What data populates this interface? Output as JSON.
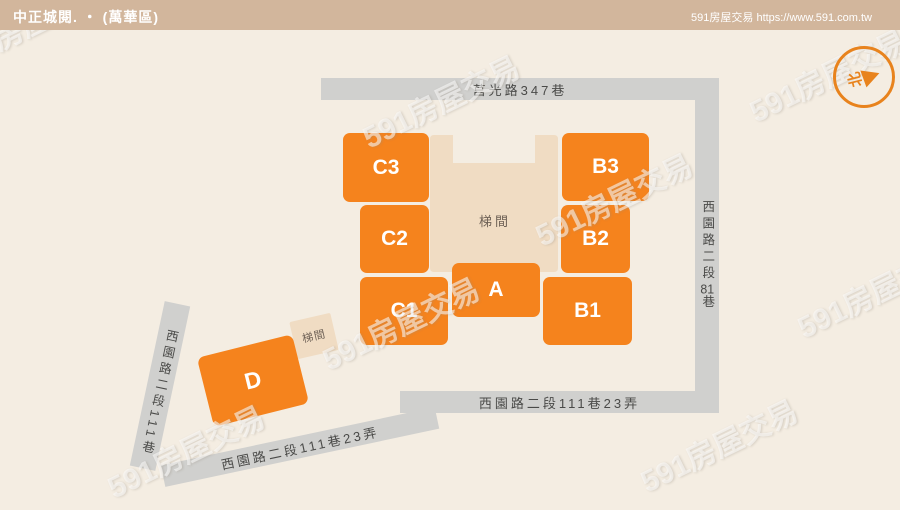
{
  "header": {
    "title": "中正城閱. ・ (萬華區)",
    "site": "591房屋交易 https://www.591.com.tw"
  },
  "compass": {
    "label": "北"
  },
  "roads": {
    "top": {
      "name": "莒光路347巷"
    },
    "right": {
      "part1": "西園路二段",
      "num": "81",
      "part2": "巷"
    },
    "bottom": {
      "name": "西園路二段111巷23弄"
    },
    "diagonal": {
      "name": "西園路二段111巷23弄"
    },
    "left": {
      "part1": "西園路二段",
      "num": "111",
      "part2": "巷"
    }
  },
  "buildings": [
    {
      "id": "C3",
      "label": "C3"
    },
    {
      "id": "B3",
      "label": "B3"
    },
    {
      "id": "C2",
      "label": "C2"
    },
    {
      "id": "B2",
      "label": "B2"
    },
    {
      "id": "C1",
      "label": "C1"
    },
    {
      "id": "A",
      "label": "A"
    },
    {
      "id": "B1",
      "label": "B1"
    },
    {
      "id": "D",
      "label": "D"
    }
  ],
  "stairwells": {
    "center": {
      "label": "梯間"
    },
    "near_d": {
      "label": "梯間"
    }
  },
  "watermark": {
    "text": "591房屋交易"
  },
  "colors": {
    "accent_orange": "#f5831d",
    "road_gray": "#d0d0ce",
    "stair_beige": "#f0dcc3",
    "header_tan": "#d2b69c",
    "background": "#f4ede2",
    "road_text": "#4a4a48"
  }
}
